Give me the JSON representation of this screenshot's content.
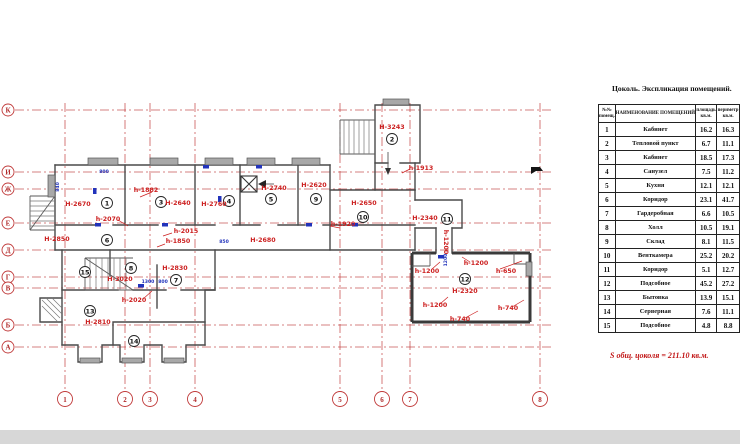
{
  "title": "Цоколь. Экспликация помещений.",
  "total_note": "S общ. цоколя = 211.10 кв.м.",
  "table": {
    "headers": {
      "num_top": "№№",
      "num_bot": "помещ.",
      "name": "НАИМЕНОВАНИЕ ПОМЕЩЕНИЙ",
      "area_top": "площадь",
      "area_bot": "кв.м.",
      "perim_top": "периметр",
      "perim_bot": "кв.м."
    },
    "rows": [
      {
        "num": "1",
        "name": "Кабинет",
        "a1": "16.2",
        "a2": "16.3"
      },
      {
        "num": "2",
        "name": "Тепловой пункт",
        "a1": "6.7",
        "a2": "11.1"
      },
      {
        "num": "3",
        "name": "Кабинет",
        "a1": "18.5",
        "a2": "17.3"
      },
      {
        "num": "4",
        "name": "Санузел",
        "a1": "7.5",
        "a2": "11.2"
      },
      {
        "num": "5",
        "name": "Кухня",
        "a1": "12.1",
        "a2": "12.1"
      },
      {
        "num": "6",
        "name": "Коридор",
        "a1": "23.1",
        "a2": "41.7"
      },
      {
        "num": "7",
        "name": "Гардеробная",
        "a1": "6.6",
        "a2": "10.5"
      },
      {
        "num": "8",
        "name": "Холл",
        "a1": "10.5",
        "a2": "19.1"
      },
      {
        "num": "9",
        "name": "Склад",
        "a1": "8.1",
        "a2": "11.5"
      },
      {
        "num": "10",
        "name": "Венткамера",
        "a1": "25.2",
        "a2": "20.2"
      },
      {
        "num": "11",
        "name": "Коридор",
        "a1": "5.1",
        "a2": "12.7"
      },
      {
        "num": "12",
        "name": "Подсобное",
        "a1": "45.2",
        "a2": "27.2"
      },
      {
        "num": "13",
        "name": "Бытовка",
        "a1": "13.9",
        "a2": "15.1"
      },
      {
        "num": "14",
        "name": "Серверная",
        "a1": "7.6",
        "a2": "11.1"
      },
      {
        "num": "15",
        "name": "Подсобное",
        "a1": "4.8",
        "a2": "8.8"
      }
    ]
  },
  "grid": {
    "row_axes": [
      {
        "label": "К",
        "y": 110
      },
      {
        "label": "И",
        "y": 172
      },
      {
        "label": "Ж",
        "y": 189
      },
      {
        "label": "Е",
        "y": 223
      },
      {
        "label": "Д",
        "y": 250
      },
      {
        "label": "Г",
        "y": 277
      },
      {
        "label": "В",
        "y": 288
      },
      {
        "label": "Б",
        "y": 325
      },
      {
        "label": "А",
        "y": 347
      }
    ],
    "col_axes": [
      {
        "label": "1",
        "x": 65
      },
      {
        "label": "2",
        "x": 125
      },
      {
        "label": "3",
        "x": 150
      },
      {
        "label": "4",
        "x": 195
      },
      {
        "label": "5",
        "x": 340
      },
      {
        "label": "6",
        "x": 382
      },
      {
        "label": "7",
        "x": 410
      },
      {
        "label": "8",
        "x": 540
      }
    ]
  },
  "rooms": [
    {
      "num": "1",
      "cx": 107,
      "cy": 203
    },
    {
      "num": "2",
      "cx": 392,
      "cy": 139
    },
    {
      "num": "3",
      "cx": 161,
      "cy": 202
    },
    {
      "num": "4",
      "cx": 229,
      "cy": 201
    },
    {
      "num": "5",
      "cx": 271,
      "cy": 199
    },
    {
      "num": "6",
      "cx": 107,
      "cy": 240
    },
    {
      "num": "7",
      "cx": 176,
      "cy": 280
    },
    {
      "num": "8",
      "cx": 131,
      "cy": 268
    },
    {
      "num": "9",
      "cx": 316,
      "cy": 199
    },
    {
      "num": "10",
      "cx": 363,
      "cy": 217
    },
    {
      "num": "11",
      "cx": 447,
      "cy": 219
    },
    {
      "num": "12",
      "cx": 465,
      "cy": 279
    },
    {
      "num": "13",
      "cx": 90,
      "cy": 311
    },
    {
      "num": "14",
      "cx": 134,
      "cy": 341
    },
    {
      "num": "15",
      "cx": 85,
      "cy": 272
    }
  ],
  "height_labels": [
    {
      "t": "Н-2670",
      "x": 78,
      "y": 206
    },
    {
      "t": "h-2070",
      "x": 108,
      "y": 221
    },
    {
      "t": "h-1882",
      "x": 146,
      "y": 192
    },
    {
      "t": "Н-2640",
      "x": 178,
      "y": 205
    },
    {
      "t": "Н-2850",
      "x": 57,
      "y": 241
    },
    {
      "t": "h-2015",
      "x": 186,
      "y": 233
    },
    {
      "t": "h-1850",
      "x": 178,
      "y": 243
    },
    {
      "t": "Н-2760",
      "x": 214,
      "y": 206
    },
    {
      "t": "Н-2740",
      "x": 274,
      "y": 190
    },
    {
      "t": "Н-2620",
      "x": 314,
      "y": 187
    },
    {
      "t": "Н-2680",
      "x": 263,
      "y": 242
    },
    {
      "t": "Н-2650",
      "x": 364,
      "y": 205
    },
    {
      "t": "h-1920",
      "x": 343,
      "y": 226
    },
    {
      "t": "Н-3243",
      "x": 392,
      "y": 129
    },
    {
      "t": "h-1913",
      "x": 421,
      "y": 170
    },
    {
      "t": "Н-2340",
      "x": 425,
      "y": 220
    },
    {
      "t": "Н-3020",
      "x": 120,
      "y": 281
    },
    {
      "t": "Н-2830",
      "x": 175,
      "y": 270
    },
    {
      "t": "h-2020",
      "x": 134,
      "y": 302
    },
    {
      "t": "Н-2810",
      "x": 98,
      "y": 324
    },
    {
      "t": "Н-2320",
      "x": 465,
      "y": 293
    },
    {
      "t": "h-1200",
      "x": 427,
      "y": 273
    },
    {
      "t": "h-1200",
      "x": 476,
      "y": 265
    },
    {
      "t": "h-650",
      "x": 506,
      "y": 273
    },
    {
      "t": "h-1200",
      "x": 435,
      "y": 307
    },
    {
      "t": "h-740",
      "x": 508,
      "y": 310
    },
    {
      "t": "h-740",
      "x": 460,
      "y": 321
    },
    {
      "t": "h-1200",
      "x": 444,
      "y": 242,
      "rot": 90
    }
  ],
  "dim_labels": [
    {
      "t": "840",
      "x": 59,
      "y": 187,
      "rot": -90
    },
    {
      "t": "800",
      "x": 104,
      "y": 173
    },
    {
      "t": "1300",
      "x": 148,
      "y": 283
    },
    {
      "t": "800",
      "x": 163,
      "y": 283
    },
    {
      "t": "850",
      "x": 224,
      "y": 243
    },
    {
      "t": "1200",
      "x": 447,
      "y": 260,
      "rot": -90
    }
  ]
}
